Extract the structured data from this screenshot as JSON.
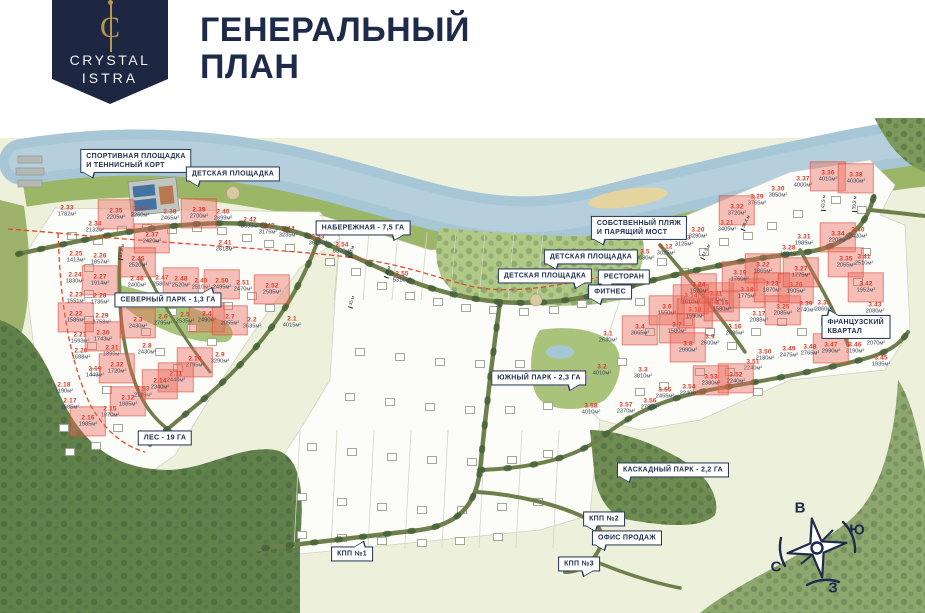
{
  "header": {
    "brand_line1": "CRYSTAL",
    "brand_line2": "ISTRA",
    "monogram": "C",
    "title_line1": "ГЕНЕРАЛЬНЫЙ",
    "title_line2": "ПЛАН"
  },
  "colors": {
    "navy": "#1e2a4a",
    "accent_red": "#d93a2b",
    "gold": "#b9974e",
    "water": "#a7c7d6",
    "shore_green": "#9cb668",
    "forest_green": "#61814a",
    "park_green": "#a9c47a",
    "road_green": "#6e7f4c",
    "highlight_fill": "#f0a79b"
  },
  "map": {
    "callouts": [
      {
        "id": "sports-ground",
        "label": "СПОРТИВНАЯ ПЛОЩАДКА\nИ ТЕННИСНЫЙ КОРТ",
        "x": 136,
        "y": 161,
        "tail": "bl"
      },
      {
        "id": "playground-north",
        "label": "ДЕТСКАЯ ПЛОЩАДКА",
        "x": 233,
        "y": 174,
        "tail": "bl"
      },
      {
        "id": "embankment",
        "label": "НАБЕРЕЖНАЯ - 7,5 ГА",
        "x": 363,
        "y": 228,
        "tail": "br"
      },
      {
        "id": "private-beach",
        "label": "СОБСТВЕННЫЙ ПЛЯЖ\nИ ПАРЯЩИЙ МОСТ",
        "x": 639,
        "y": 228,
        "tail": "bl"
      },
      {
        "id": "playground-right",
        "label": "ДЕТСКАЯ ПЛОЩАДКА",
        "x": 591,
        "y": 257,
        "tail": "bl"
      },
      {
        "id": "playground-center",
        "label": "ДЕТСКАЯ ПЛОЩАДКА",
        "x": 545,
        "y": 276,
        "tail": "br"
      },
      {
        "id": "restaurant",
        "label": "РЕСТОРАН",
        "x": 624,
        "y": 277,
        "tail": "bl"
      },
      {
        "id": "fitness",
        "label": "ФИТНЕС",
        "x": 610,
        "y": 292,
        "tail": "bl"
      },
      {
        "id": "north-park",
        "label": "СЕВЕРНЫЙ ПАРК - 1,3 ГА",
        "x": 168,
        "y": 300,
        "tail": "tr"
      },
      {
        "id": "south-park",
        "label": "ЮЖНЫЙ ПАРК - 2,3 ГА",
        "x": 539,
        "y": 378,
        "tail": "br"
      },
      {
        "id": "french-quarter",
        "label": "ФРАНЦУЗСКИЙ КВАРТАЛ",
        "x": 856,
        "y": 327,
        "tail": "tl"
      },
      {
        "id": "forest",
        "label": "ЛЕС - 19 ГА",
        "x": 165,
        "y": 438,
        "tail": ""
      },
      {
        "id": "cascade-park",
        "label": "КАСКАДНЫЙ ПАРК - 2,2 ГА",
        "x": 673,
        "y": 470,
        "tail": "bl"
      },
      {
        "id": "checkpoint-2",
        "label": "КПП №2",
        "x": 604,
        "y": 519,
        "tail": "bl"
      },
      {
        "id": "sales-office",
        "label": "ОФИС ПРОДАЖ",
        "x": 627,
        "y": 538,
        "tail": "bl"
      },
      {
        "id": "checkpoint-1",
        "label": "КПП №1",
        "x": 352,
        "y": 554,
        "tail": "tr"
      },
      {
        "id": "checkpoint-3",
        "label": "КПП №3",
        "x": 579,
        "y": 564,
        "tail": "br"
      }
    ],
    "plots": [
      {
        "n": "2.1",
        "a": "4015м²",
        "x": 292,
        "y": 322,
        "hl": false
      },
      {
        "n": "2.2",
        "a": "3635м²",
        "x": 252,
        "y": 323,
        "hl": false
      },
      {
        "n": "2.3",
        "a": "2430м²",
        "x": 138,
        "y": 323,
        "hl": true
      },
      {
        "n": "2.4",
        "a": "2490м²",
        "x": 207,
        "y": 317,
        "hl": true
      },
      {
        "n": "2.5",
        "a": "2535м²",
        "x": 185,
        "y": 318,
        "hl": false
      },
      {
        "n": "2.6",
        "a": "2795м²",
        "x": 163,
        "y": 320,
        "hl": false
      },
      {
        "n": "2.7",
        "a": "2055м²",
        "x": 230,
        "y": 320,
        "hl": true
      },
      {
        "n": "2.8",
        "a": "2430м²",
        "x": 147,
        "y": 349,
        "hl": false
      },
      {
        "n": "2.9",
        "a": "3290м²",
        "x": 220,
        "y": 358,
        "hl": false
      },
      {
        "n": "2.10",
        "a": "2795м²",
        "x": 195,
        "y": 362,
        "hl": true
      },
      {
        "n": "2.11",
        "a": "2440м²",
        "x": 176,
        "y": 377,
        "hl": true
      },
      {
        "n": "2.12",
        "a": "1885м²",
        "x": 128,
        "y": 401,
        "hl": true
      },
      {
        "n": "2.13",
        "a": "2115м²",
        "x": 143,
        "y": 392,
        "hl": false
      },
      {
        "n": "2.14",
        "a": "2340м²",
        "x": 160,
        "y": 384,
        "hl": true
      },
      {
        "n": "2.15",
        "a": "1870м²",
        "x": 110,
        "y": 412,
        "hl": false
      },
      {
        "n": "2.16",
        "a": "1985м²",
        "x": 88,
        "y": 421,
        "hl": true
      },
      {
        "n": "2.17",
        "a": "1685м²",
        "x": 70,
        "y": 404,
        "hl": false
      },
      {
        "n": "2.18",
        "a": "1190м²",
        "x": 64,
        "y": 388,
        "hl": false
      },
      {
        "n": "2.19",
        "a": "1449м²",
        "x": 95,
        "y": 372,
        "hl": false
      },
      {
        "n": "2.20",
        "a": "1688м²",
        "x": 81,
        "y": 354,
        "hl": false
      },
      {
        "n": "2.21",
        "a": "1593м²",
        "x": 80,
        "y": 338,
        "hl": false
      },
      {
        "n": "2.22",
        "a": "1586м²",
        "x": 76,
        "y": 317,
        "hl": true
      },
      {
        "n": "2.23",
        "a": "1551м²",
        "x": 76,
        "y": 298,
        "hl": false
      },
      {
        "n": "2.24",
        "a": "1830м²",
        "x": 75,
        "y": 278,
        "hl": false
      },
      {
        "n": "2.25",
        "a": "1413м²",
        "x": 76,
        "y": 257,
        "hl": false
      },
      {
        "n": "2.26",
        "a": "1857м²",
        "x": 100,
        "y": 259,
        "hl": false
      },
      {
        "n": "2.27",
        "a": "1914м²",
        "x": 100,
        "y": 280,
        "hl": true
      },
      {
        "n": "2.28",
        "a": "1736м²",
        "x": 100,
        "y": 299,
        "hl": false
      },
      {
        "n": "2.29",
        "a": "1758м²",
        "x": 102,
        "y": 319,
        "hl": false
      },
      {
        "n": "2.30",
        "a": "1743м²",
        "x": 103,
        "y": 336,
        "hl": true
      },
      {
        "n": "2.31",
        "a": "1899м²",
        "x": 112,
        "y": 351,
        "hl": false
      },
      {
        "n": "2.32",
        "a": "1720м²",
        "x": 117,
        "y": 368,
        "hl": true
      },
      {
        "n": "2.33",
        "a": "1782м²",
        "x": 67,
        "y": 211,
        "hl": false
      },
      {
        "n": "2.34",
        "a": "2132м²",
        "x": 95,
        "y": 227,
        "hl": false
      },
      {
        "n": "2.35",
        "a": "2205м²",
        "x": 116,
        "y": 214,
        "hl": true
      },
      {
        "n": "2.36",
        "a": "2260м²",
        "x": 140,
        "y": 212,
        "hl": false
      },
      {
        "n": "2.37",
        "a": "2420м²",
        "x": 152,
        "y": 238,
        "hl": true
      },
      {
        "n": "2.38",
        "a": "2465м²",
        "x": 170,
        "y": 215,
        "hl": false
      },
      {
        "n": "2.39",
        "a": "2700м²",
        "x": 199,
        "y": 213,
        "hl": true
      },
      {
        "n": "2.40",
        "a": "2899м²",
        "x": 223,
        "y": 215,
        "hl": false
      },
      {
        "n": "2.41",
        "a": "2618м²",
        "x": 225,
        "y": 246,
        "hl": false
      },
      {
        "n": "2.42",
        "a": "3035м²",
        "x": 250,
        "y": 223,
        "hl": false
      },
      {
        "n": "2.43",
        "a": "3175м²",
        "x": 268,
        "y": 229,
        "hl": false
      },
      {
        "n": "2.44",
        "a": "3235м²",
        "x": 288,
        "y": 232,
        "hl": false
      },
      {
        "n": "2.45",
        "a": "2520м²",
        "x": 138,
        "y": 262,
        "hl": true
      },
      {
        "n": "2.46",
        "a": "2400м²",
        "x": 137,
        "y": 282,
        "hl": false
      },
      {
        "n": "2.47",
        "a": "2580м²",
        "x": 162,
        "y": 281,
        "hl": false
      },
      {
        "n": "2.48",
        "a": "2520м²",
        "x": 181,
        "y": 282,
        "hl": true
      },
      {
        "n": "2.49",
        "a": "2510м²",
        "x": 201,
        "y": 284,
        "hl": false
      },
      {
        "n": "2.50",
        "a": "2495м²",
        "x": 222,
        "y": 284,
        "hl": true
      },
      {
        "n": "2.51",
        "a": "2470м²",
        "x": 243,
        "y": 286,
        "hl": false
      },
      {
        "n": "2.52",
        "a": "2585м²",
        "x": 272,
        "y": 289,
        "hl": true
      },
      {
        "n": "2.53",
        "a": "3625м²",
        "x": 318,
        "y": 240,
        "hl": false
      },
      {
        "n": "2.54",
        "a": "6370м²",
        "x": 342,
        "y": 248,
        "hl": false
      },
      {
        "n": "2.55",
        "a": "5310м²",
        "x": 402,
        "y": 277,
        "hl": false
      },
      {
        "n": "3.1",
        "a": "2630м²",
        "x": 608,
        "y": 337,
        "hl": false
      },
      {
        "n": "3.2",
        "a": "4010м²",
        "x": 602,
        "y": 370,
        "hl": false
      },
      {
        "n": "3.3",
        "a": "3810м²",
        "x": 643,
        "y": 373,
        "hl": false
      },
      {
        "n": "3.4",
        "a": "3665м²",
        "x": 640,
        "y": 330,
        "hl": true
      },
      {
        "n": "3.5",
        "a": "3030м²",
        "x": 645,
        "y": 255,
        "hl": false
      },
      {
        "n": "3.6",
        "a": "1550м²",
        "x": 667,
        "y": 310,
        "hl": true
      },
      {
        "n": "3.7",
        "a": "1580м²",
        "x": 677,
        "y": 328,
        "hl": true
      },
      {
        "n": "3.8",
        "a": "2990м²",
        "x": 688,
        "y": 347,
        "hl": true
      },
      {
        "n": "3.9",
        "a": "2600м²",
        "x": 710,
        "y": 340,
        "hl": false
      },
      {
        "n": "3.10",
        "a": "1590м²",
        "x": 695,
        "y": 313,
        "hl": true
      },
      {
        "n": "3.11",
        "a": "1990м²",
        "x": 716,
        "y": 297,
        "hl": true
      },
      {
        "n": "3.12",
        "a": "3025м²",
        "x": 666,
        "y": 250,
        "hl": false
      },
      {
        "n": "3.13",
        "a": "3125м²",
        "x": 684,
        "y": 241,
        "hl": false
      },
      {
        "n": "3.14",
        "a": "1610м²",
        "x": 691,
        "y": 299,
        "hl": true
      },
      {
        "n": "3.15",
        "a": "1580м²",
        "x": 722,
        "y": 306,
        "hl": true
      },
      {
        "n": "3.16",
        "a": "2636м²",
        "x": 735,
        "y": 330,
        "hl": false
      },
      {
        "n": "3.17",
        "a": "2088м²",
        "x": 759,
        "y": 317,
        "hl": false
      },
      {
        "n": "3.18",
        "a": "1775м²",
        "x": 747,
        "y": 293,
        "hl": true
      },
      {
        "n": "3.19",
        "a": "1760м²",
        "x": 740,
        "y": 276,
        "hl": true
      },
      {
        "n": "3.20",
        "a": "3290м²",
        "x": 698,
        "y": 233,
        "hl": false
      },
      {
        "n": "3.21",
        "a": "3405м²",
        "x": 727,
        "y": 226,
        "hl": false
      },
      {
        "n": "3.22",
        "a": "1865м²",
        "x": 763,
        "y": 268,
        "hl": true
      },
      {
        "n": "3.23",
        "a": "1870м²",
        "x": 772,
        "y": 287,
        "hl": true
      },
      {
        "n": "3.24",
        "a": "1520м²",
        "x": 699,
        "y": 288,
        "hl": true
      },
      {
        "n": "3.25",
        "a": "2085м²",
        "x": 783,
        "y": 310,
        "hl": true
      },
      {
        "n": "3.26",
        "a": "1905м²",
        "x": 796,
        "y": 288,
        "hl": true
      },
      {
        "n": "3.27",
        "a": "1775м²",
        "x": 801,
        "y": 272,
        "hl": true
      },
      {
        "n": "3.28",
        "a": "1684м²",
        "x": 789,
        "y": 251,
        "hl": false
      },
      {
        "n": "3.29",
        "a": "3765м²",
        "x": 757,
        "y": 200,
        "hl": false
      },
      {
        "n": "3.30",
        "a": "3850м²",
        "x": 778,
        "y": 192,
        "hl": false
      },
      {
        "n": "3.31",
        "a": "1985м²",
        "x": 804,
        "y": 240,
        "hl": false
      },
      {
        "n": "3.32",
        "a": "3720м²",
        "x": 737,
        "y": 210,
        "hl": true
      },
      {
        "n": "3.33",
        "a": "2860м²",
        "x": 824,
        "y": 306,
        "hl": false
      },
      {
        "n": "3.34",
        "a": "2208м²",
        "x": 838,
        "y": 237,
        "hl": true
      },
      {
        "n": "3.35",
        "a": "2055м²",
        "x": 846,
        "y": 262,
        "hl": true
      },
      {
        "n": "3.36",
        "a": "4010м²",
        "x": 828,
        "y": 176,
        "hl": true
      },
      {
        "n": "3.37",
        "a": "4000м²",
        "x": 803,
        "y": 182,
        "hl": false
      },
      {
        "n": "3.38",
        "a": "4030м²",
        "x": 856,
        "y": 178,
        "hl": true
      },
      {
        "n": "3.39",
        "a": "2740м²",
        "x": 806,
        "y": 307,
        "hl": false
      },
      {
        "n": "3.40",
        "a": "2420м²",
        "x": 858,
        "y": 233,
        "hl": false
      },
      {
        "n": "3.41",
        "a": "2510м²",
        "x": 864,
        "y": 260,
        "hl": false
      },
      {
        "n": "3.42",
        "a": "1952м²",
        "x": 866,
        "y": 287,
        "hl": true
      },
      {
        "n": "3.43",
        "a": "2080м²",
        "x": 875,
        "y": 308,
        "hl": false
      },
      {
        "n": "3.44",
        "a": "2070м²",
        "x": 876,
        "y": 340,
        "hl": false
      },
      {
        "n": "3.45",
        "a": "1935м²",
        "x": 881,
        "y": 361,
        "hl": false
      },
      {
        "n": "3.46",
        "a": "3190м²",
        "x": 855,
        "y": 348,
        "hl": false
      },
      {
        "n": "3.47",
        "a": "2990м²",
        "x": 831,
        "y": 348,
        "hl": true
      },
      {
        "n": "3.48",
        "a": "2765м²",
        "x": 810,
        "y": 350,
        "hl": false
      },
      {
        "n": "3.49",
        "a": "2475м²",
        "x": 789,
        "y": 352,
        "hl": false
      },
      {
        "n": "3.50",
        "a": "2180м²",
        "x": 765,
        "y": 355,
        "hl": false
      },
      {
        "n": "3.51",
        "a": "2240м²",
        "x": 753,
        "y": 365,
        "hl": false
      },
      {
        "n": "3.52",
        "a": "2240м²",
        "x": 736,
        "y": 378,
        "hl": true
      },
      {
        "n": "3.53",
        "a": "2380м²",
        "x": 711,
        "y": 380,
        "hl": true
      },
      {
        "n": "3.54",
        "a": "2240м²",
        "x": 689,
        "y": 390,
        "hl": false
      },
      {
        "n": "3.55",
        "a": "2455м²",
        "x": 665,
        "y": 393,
        "hl": false
      },
      {
        "n": "3.56",
        "a": "2750м²",
        "x": 650,
        "y": 404,
        "hl": false
      },
      {
        "n": "3.57",
        "a": "2370м²",
        "x": 626,
        "y": 408,
        "hl": false
      },
      {
        "n": "3.58",
        "a": "4010м²",
        "x": 591,
        "y": 409,
        "hl": false
      }
    ],
    "dimensions": [
      {
        "t": "27,5 м",
        "x": 122,
        "y": 252,
        "r": -78
      },
      {
        "t": "28 м",
        "x": 352,
        "y": 252,
        "r": -75
      },
      {
        "t": "35 м",
        "x": 388,
        "y": 272,
        "r": -70
      },
      {
        "t": "35 м",
        "x": 352,
        "y": 302,
        "r": -72
      },
      {
        "t": "38,4 м",
        "x": 746,
        "y": 223,
        "r": -65
      },
      {
        "t": "42,5 м",
        "x": 706,
        "y": 252,
        "r": -62
      },
      {
        "t": "43,5 м",
        "x": 824,
        "y": 203,
        "r": -85
      },
      {
        "t": "39,3 м",
        "x": 855,
        "y": 204,
        "r": -85
      }
    ],
    "compass": {
      "east": "В",
      "south": "Ю",
      "north": "С",
      "west": "З",
      "positions": {
        "east": [
          800,
          508
        ],
        "south": [
          857,
          530
        ],
        "north": [
          776,
          567
        ],
        "west": [
          833,
          588
        ]
      }
    }
  }
}
